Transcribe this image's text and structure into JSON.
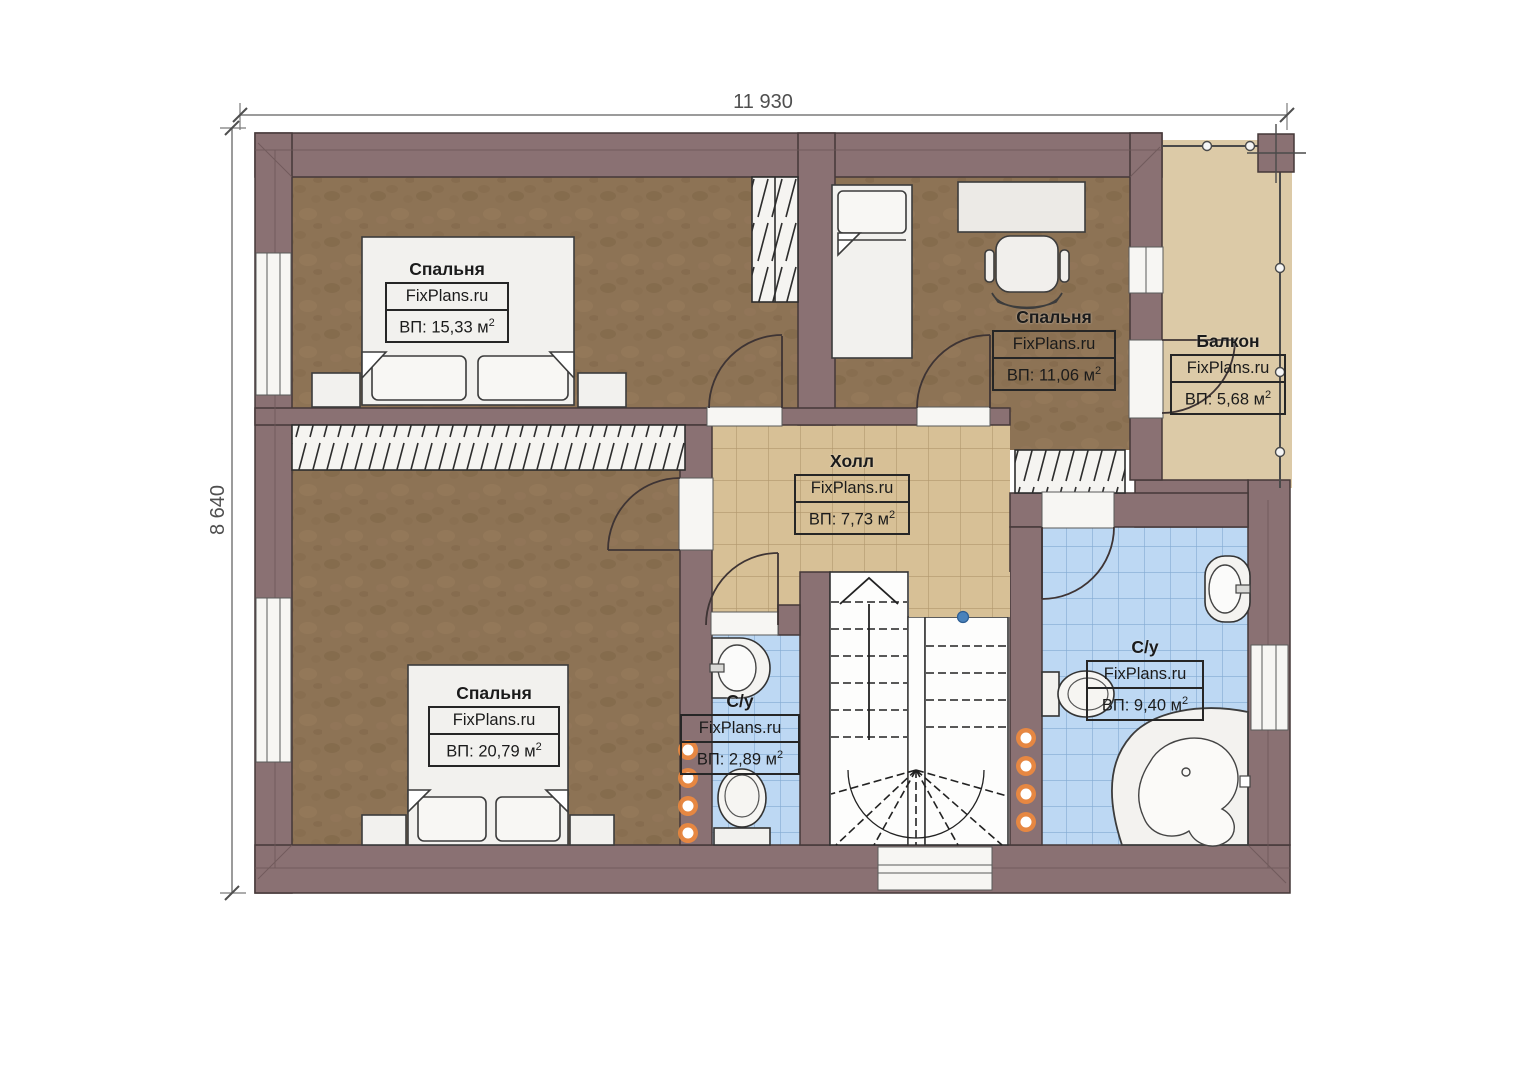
{
  "plan": {
    "dimensions": {
      "width_label": "11 930",
      "height_label": "8 640"
    },
    "rooms": [
      {
        "key": "bedroom-top-left",
        "name": "Спальня",
        "watermark": "FixPlans.ru",
        "area_main": "ВП: 15,33 м",
        "area_sup": "2"
      },
      {
        "key": "bedroom-top-right",
        "name": "Спальня",
        "watermark": "FixPlans.ru",
        "area_main": "ВП: 11,06 м",
        "area_sup": "2"
      },
      {
        "key": "balcony",
        "name": "Балкон",
        "watermark": "FixPlans.ru",
        "area_main": "ВП: 5,68 м",
        "area_sup": "2"
      },
      {
        "key": "hall",
        "name": "Холл",
        "watermark": "FixPlans.ru",
        "area_main": "ВП: 7,73 м",
        "area_sup": "2"
      },
      {
        "key": "bedroom-bottom-left",
        "name": "Спальня",
        "watermark": "FixPlans.ru",
        "area_main": "ВП: 20,79 м",
        "area_sup": "2"
      },
      {
        "key": "bathroom-small",
        "name": "С/у",
        "watermark": "FixPlans.ru",
        "area_main": "ВП: 2,89 м",
        "area_sup": "2"
      },
      {
        "key": "bathroom-large",
        "name": "С/у",
        "watermark": "FixPlans.ru",
        "area_main": "ВП: 9,40 м",
        "area_sup": "2"
      }
    ],
    "colors": {
      "wall": "#8a7173",
      "bedroom_floor": "#8d7355",
      "hall_tile": "#d7c096",
      "bath_tile": "#bdd8f3",
      "balcony_floor": "#dccaa7",
      "fixture": "#f2f1ee",
      "accent_dot": "#ef8a3d",
      "stair_marker": "#4a82bb"
    }
  }
}
